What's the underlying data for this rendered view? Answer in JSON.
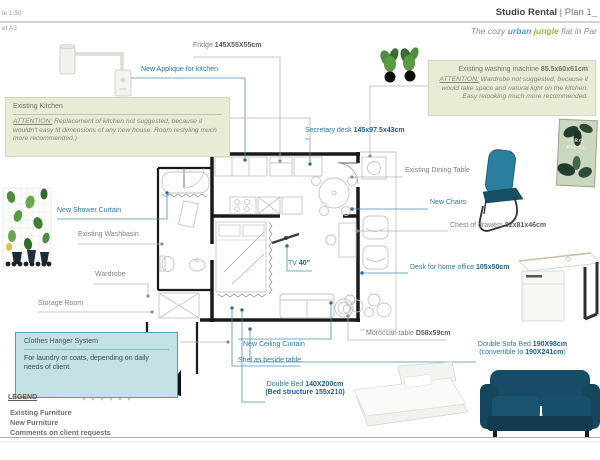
{
  "meta": {
    "scale_top": "le 1:50",
    "scale_bottom": "et A3"
  },
  "header": {
    "title_bold": "Studio Rental",
    "title_rest": " | Plan 1_",
    "subtitle_a": "The cozy ",
    "subtitle_urban": "urban",
    "subtitle_jungle": " jungle",
    "subtitle_b": " flat in Par"
  },
  "boxes": {
    "kitchen": {
      "title": "Existing Kitchen",
      "attention_label": "ATTENTION:",
      "attention_text": " Replacement of kitchen not suggested, because it wouldn't easy fit dimensions of any new house. Room restyling much more recommended.)"
    },
    "washing": {
      "line_a": "Existing washing machine ",
      "line_b": "85.5x60x61cm",
      "attention_label": "ATTENTION:",
      "attention_text": " Wardrobe not suggested, because it would take space and natural light on the kitchen. Easy relooking much more recommended."
    },
    "hanger": {
      "title": "Clothes Hanger System",
      "body": "For laundry or coats, depending on daily needs of client."
    }
  },
  "labels": {
    "fridge_a": "Fridge ",
    "fridge_b": "145X55X55cm",
    "applique": "New Applique for kitchen",
    "secretary_a": "Secretary desk ",
    "secretary_b": "145x97.5x43cm",
    "dining": "Existing Dining Table",
    "chairs": "New Chairs",
    "chest_a": "Chest of drawers ",
    "chest_b": "82x81x46cm",
    "desk_a": "Desk for home office ",
    "desk_b": "105x50cm",
    "moroccan_a": "Moroccan table ",
    "moroccan_b": "D58x59cm",
    "sofa_l1a": "Double Sofa Bed ",
    "sofa_l1b": "190X98cm",
    "sofa_l2a": "(convertible to ",
    "sofa_l2b": "190X241cm",
    "sofa_l2c": ")",
    "tv_a": "TV ",
    "tv_b": "40\"",
    "ceiling": "New Ceiling Curtain",
    "shelf": "Shel as beside table",
    "bed_l1a": "Double Bed ",
    "bed_l1b": "140X200cm",
    "bed_l2": "(Bed structure 155x210)",
    "shower": "New Shower Curtain",
    "washbasin": "Existing Washbasin",
    "wardrobe": "Wardrobe",
    "storage": "Storage Room"
  },
  "legend": {
    "title": "LEGEND",
    "items": [
      "Existing Furniture",
      "New Furniture",
      "Comments on client requests"
    ]
  },
  "poster": {
    "line1": "TRO",
    "line2": "PICAL"
  },
  "colors": {
    "new_items": "#2d7ba6",
    "existing_items": "#82827a",
    "comment_box_bg": "#e9ecd4",
    "hanger_box_bg": "#c4e1e5",
    "hanger_box_border": "#4aa4b0",
    "urban_word": "#4f9ec9",
    "jungle_word": "#8fbe3f",
    "walls": "#1a1a1a"
  }
}
